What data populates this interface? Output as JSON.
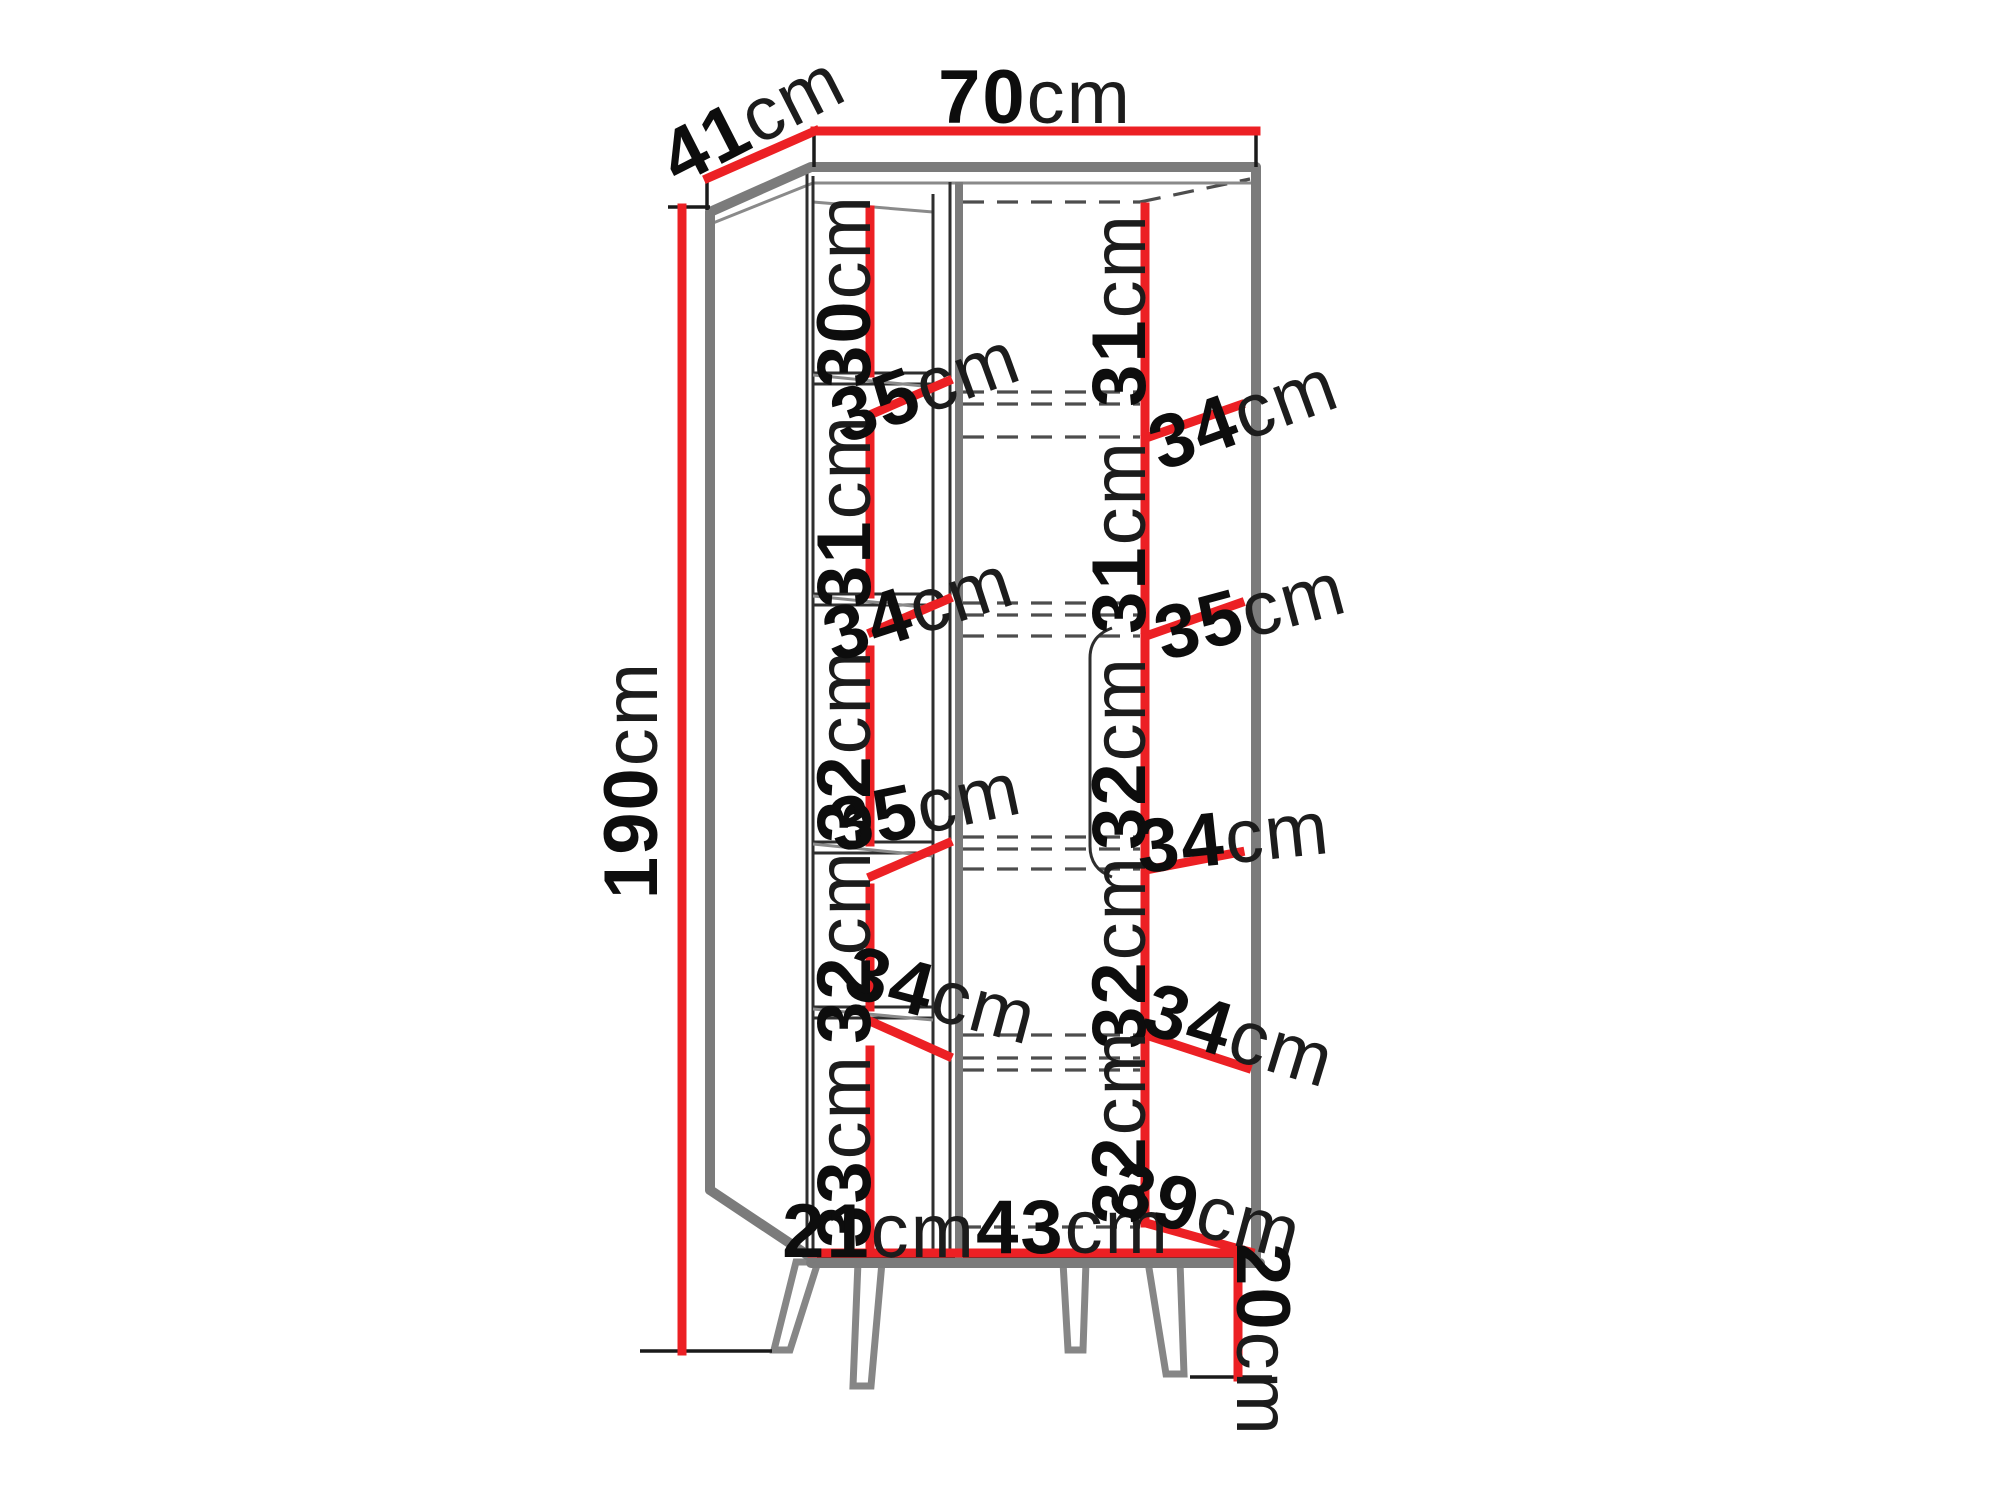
{
  "figure": {
    "kind": "furniture-dimension-diagram",
    "subject": "corner cabinet with shelves and splayed legs",
    "accent_color": "#ec2024",
    "line_color": "#2e2e2e"
  },
  "dims": {
    "top_depth": {
      "value": "41",
      "unit": "cm"
    },
    "top_width": {
      "value": "70",
      "unit": "cm"
    },
    "height": {
      "value": "190",
      "unit": "cm"
    },
    "left_column_heights": [
      {
        "value": "30",
        "unit": "cm"
      },
      {
        "value": "31",
        "unit": "cm"
      },
      {
        "value": "32",
        "unit": "cm"
      },
      {
        "value": "32",
        "unit": "cm"
      },
      {
        "value": "33",
        "unit": "cm"
      }
    ],
    "left_shelf_depths": [
      {
        "value": "35",
        "unit": "cm"
      },
      {
        "value": "34",
        "unit": "cm"
      },
      {
        "value": "35",
        "unit": "cm"
      },
      {
        "value": "34",
        "unit": "cm"
      }
    ],
    "bottom_left_width": {
      "value": "21",
      "unit": "cm"
    },
    "bottom_right_width": {
      "value": "43",
      "unit": "cm"
    },
    "right_column_heights": [
      {
        "value": "31",
        "unit": "cm"
      },
      {
        "value": "31",
        "unit": "cm"
      },
      {
        "value": "32",
        "unit": "cm"
      },
      {
        "value": "32",
        "unit": "cm"
      },
      {
        "value": "32",
        "unit": "cm"
      }
    ],
    "right_shelf_depths": [
      {
        "value": "34",
        "unit": "cm"
      },
      {
        "value": "35",
        "unit": "cm"
      },
      {
        "value": "34",
        "unit": "cm"
      },
      {
        "value": "34",
        "unit": "cm"
      },
      {
        "value": "39",
        "unit": "cm"
      }
    ],
    "leg_height": {
      "value": "20",
      "unit": "cm"
    }
  }
}
